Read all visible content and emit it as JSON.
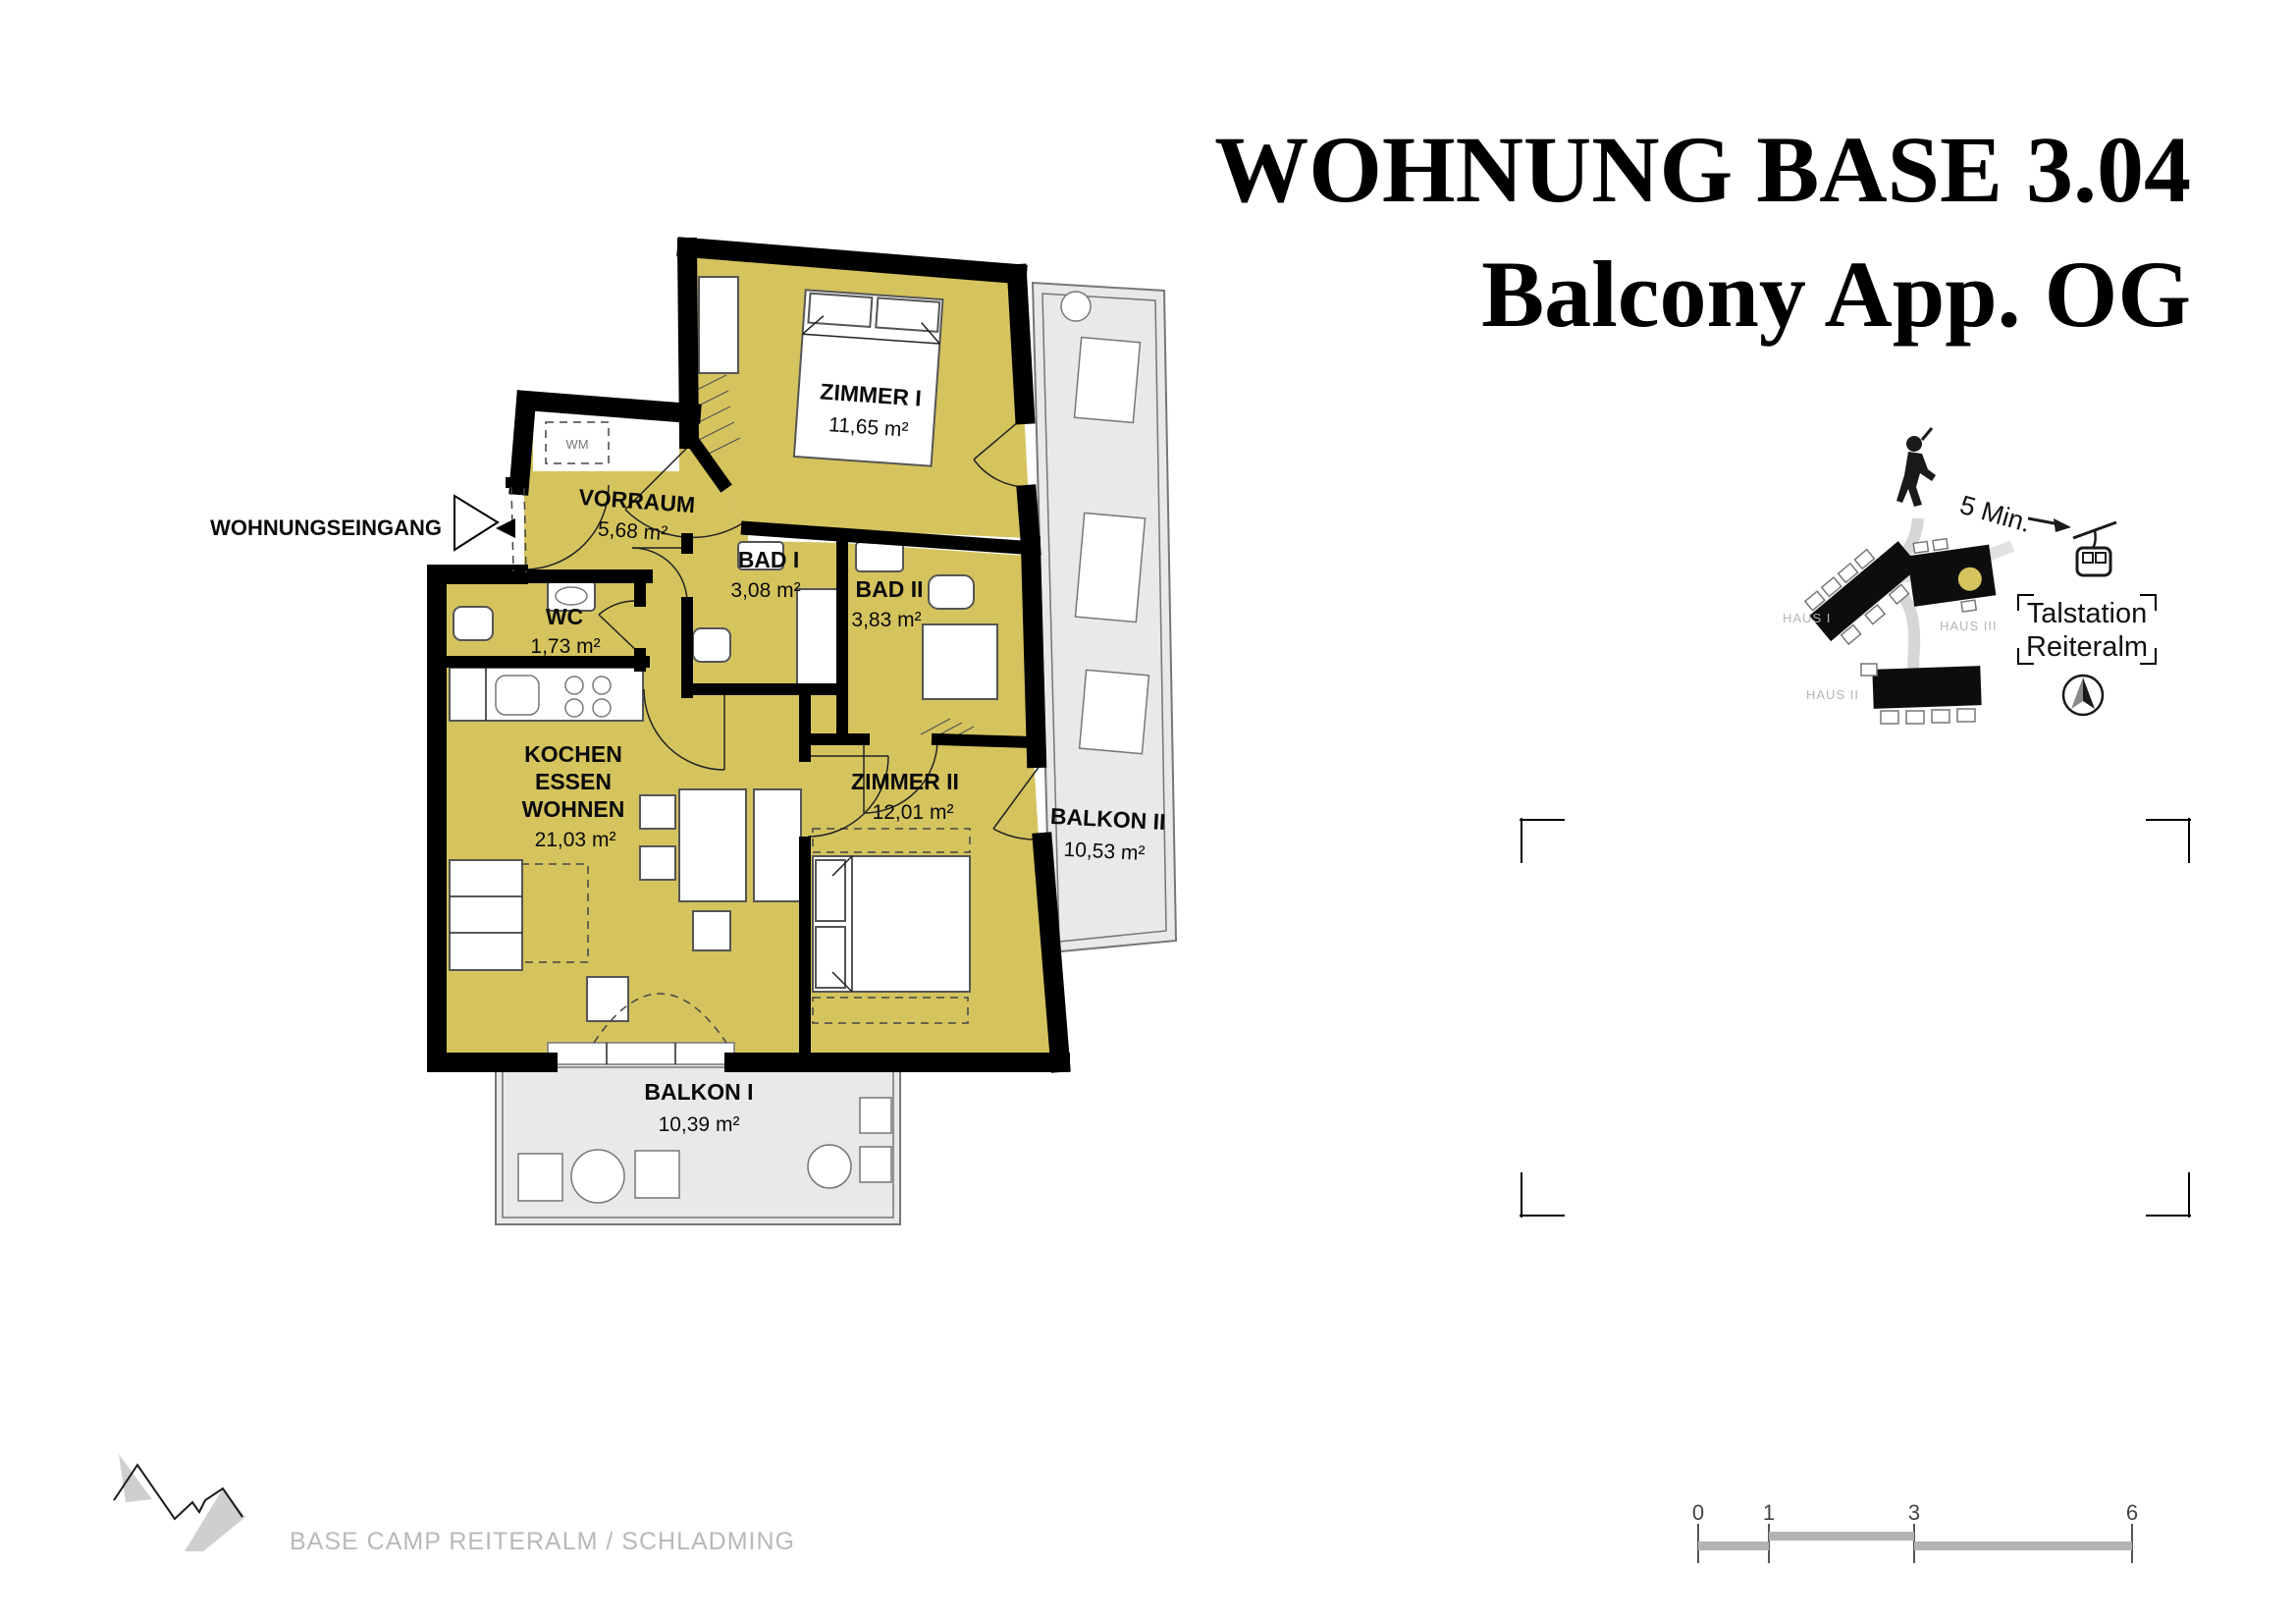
{
  "title": {
    "line1": "WOHNUNG BASE 3.04",
    "line2": "Balcony App. OG"
  },
  "plan": {
    "entrance_label": "WOHNUNGSEINGANG",
    "wm_label": "WM",
    "rooms": {
      "zimmer1": {
        "name": "ZIMMER I",
        "area": "11,65 m²"
      },
      "vorraum": {
        "name": "VORRAUM",
        "area": "5,68 m²"
      },
      "bad1": {
        "name": "BAD I",
        "area": "3,08 m²"
      },
      "bad2": {
        "name": "BAD II",
        "area": "3,83 m²"
      },
      "wc": {
        "name": "WC",
        "area": "1,73 m²"
      },
      "living": {
        "line1": "KOCHEN",
        "line2": "ESSEN",
        "line3": "WOHNEN",
        "area": "21,03 m²"
      },
      "zimmer2": {
        "name": "ZIMMER II",
        "area": "12,01 m²"
      },
      "balkon1": {
        "name": "BALKON I",
        "area": "10,39 m²"
      },
      "balkon2": {
        "name": "BALKON II",
        "area": "10,53 m²"
      }
    }
  },
  "sitemap": {
    "walk_time": "5 Min.",
    "station": {
      "line1": "Talstation",
      "line2": "Reiteralm"
    },
    "houses": {
      "haus1": "HAUS I",
      "haus2": "HAUS II",
      "haus3": "HAUS III"
    }
  },
  "footer": {
    "logo_text": "BASE CAMP REITERALM / SCHLADMING"
  },
  "scalebar": {
    "labels": [
      "0",
      "1",
      "3",
      "6"
    ]
  },
  "colors": {
    "room_fill": "#d5c45e",
    "balcony_fill": "#e9e9e7",
    "wall": "#000000",
    "marker_dot": "#d5c45e",
    "muted_text": "#b5b5b5"
  }
}
